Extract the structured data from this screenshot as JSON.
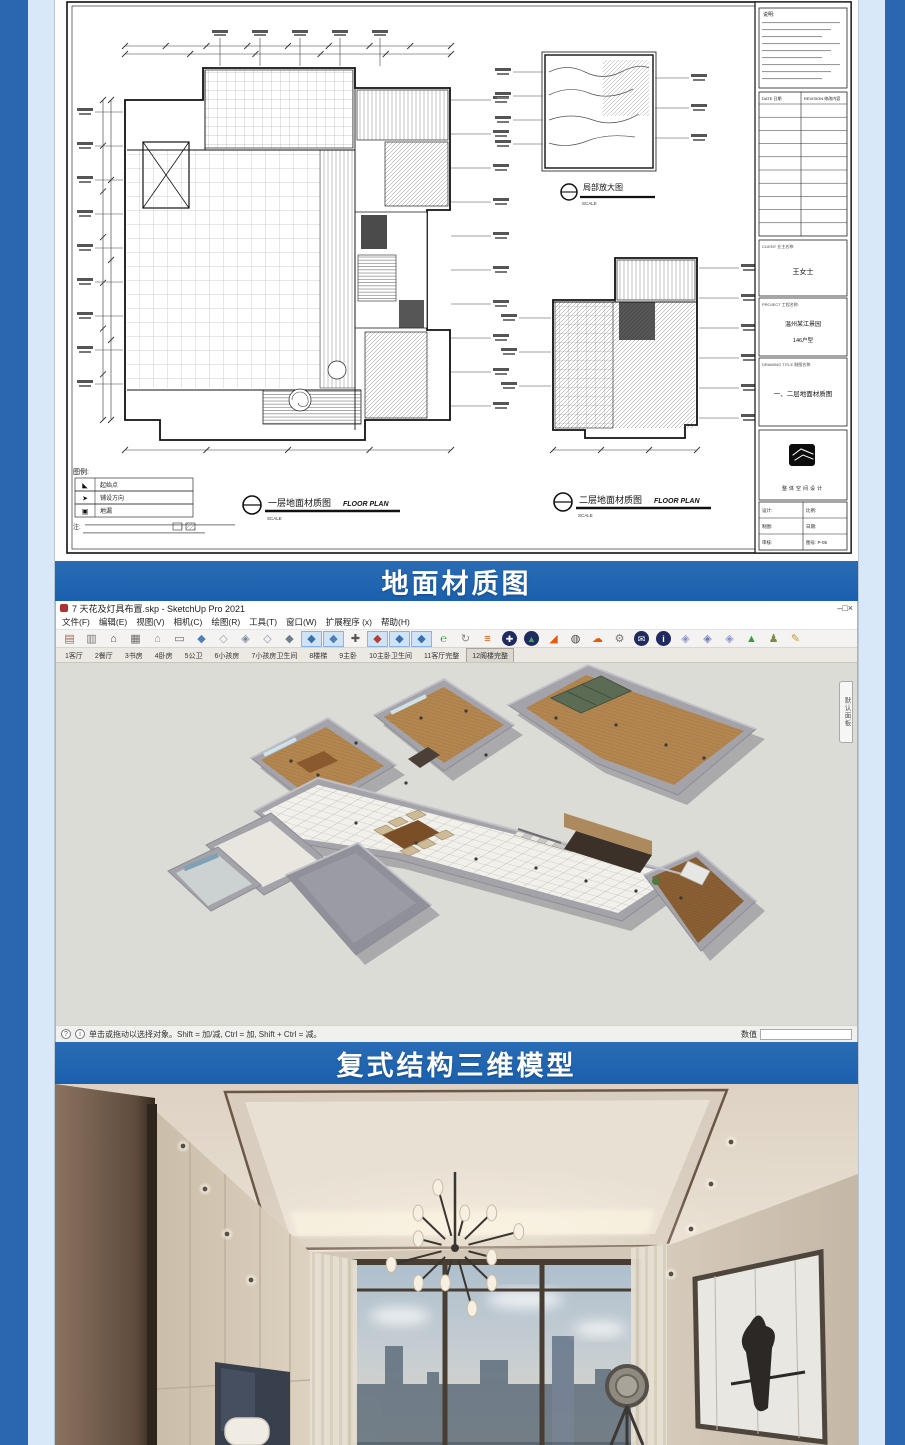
{
  "banners": {
    "floor_material": "地面材质图",
    "duplex_model": "复式结构三维模型"
  },
  "cad": {
    "captions": {
      "plan1": "一层地面材质图",
      "plan2": "二层地面材质图",
      "en": "FLOOR PLAN",
      "detail": "局部放大图",
      "scale": "SCALE"
    },
    "legend": {
      "title": "图例:",
      "rows": [
        {
          "icon": "start-point-icon",
          "glyph": "◣",
          "label": "起始点"
        },
        {
          "icon": "lay-direction-icon",
          "glyph": "➤",
          "label": "铺设方向"
        },
        {
          "icon": "floor-drain-icon",
          "glyph": "▣",
          "label": "地漏"
        }
      ],
      "note_label": "注:"
    },
    "titleblock": {
      "notes_title": "说明:",
      "rev_cols": [
        "DATE 日期",
        "REVISION 修改内容"
      ],
      "client_label": "CLIENT 业主名称:",
      "client_value": "王女士",
      "project_label": "PROJECT 工程名称:",
      "project_value": "温州某江景园",
      "project_unit": "146户型",
      "drawing_label": "DRAWING TITLE 制图名称:",
      "drawing_value": "一、二层地面材质图",
      "logo_text": "整体空间设计",
      "fields": [
        [
          "设计:",
          "比例:"
        ],
        [
          "制图:",
          "日期:"
        ],
        [
          "审核:",
          "图号: P-05"
        ]
      ]
    }
  },
  "sketchup": {
    "title": "7 天花及灯具布置.skp - SketchUp Pro 2021",
    "window_controls": [
      {
        "name": "minimize-button",
        "glyph": "–"
      },
      {
        "name": "maximize-button",
        "glyph": "□"
      },
      {
        "name": "close-button",
        "glyph": "×"
      }
    ],
    "menus": [
      "文件(F)",
      "编辑(E)",
      "视图(V)",
      "相机(C)",
      "绘图(R)",
      "工具(T)",
      "窗口(W)",
      "扩展程序 (x)",
      "帮助(H)"
    ],
    "toolbar_icons": [
      {
        "name": "model-cabinet",
        "glyph": "▤",
        "color": "#9a6a5a"
      },
      {
        "name": "component-box",
        "glyph": "▥",
        "color": "#7a7a7a"
      },
      {
        "name": "home",
        "glyph": "⌂",
        "color": "#4a4a4a"
      },
      {
        "name": "archive-box",
        "glyph": "▦",
        "color": "#6a6a6a"
      },
      {
        "name": "house-outline",
        "glyph": "⌂",
        "color": "#8a8a8a"
      },
      {
        "name": "tray-box",
        "glyph": "▭",
        "color": "#666666"
      },
      {
        "name": "cube-shaded",
        "glyph": "◆",
        "color": "#4f7fb5"
      },
      {
        "name": "cube-wire",
        "glyph": "◇",
        "color": "#9aa4ad"
      },
      {
        "name": "cube-xray",
        "glyph": "◈",
        "color": "#7d8b99"
      },
      {
        "name": "cube-hidden",
        "glyph": "◇",
        "color": "#8d9aa6"
      },
      {
        "name": "cube-mono",
        "glyph": "◆",
        "color": "#6f7e8c"
      },
      {
        "name": "cube-textured",
        "glyph": "◆",
        "color": "#3e6ea8",
        "hl": true
      },
      {
        "name": "cube-color",
        "glyph": "◆",
        "color": "#4f7fb5",
        "hl": true
      },
      {
        "name": "move-tool",
        "glyph": "✚",
        "color": "#555555"
      },
      {
        "name": "rotate-tool",
        "glyph": "◆",
        "color": "#b04038",
        "hl": true
      },
      {
        "name": "scale-tool",
        "glyph": "◆",
        "color": "#3a6fae",
        "hl": true
      },
      {
        "name": "offset-tool",
        "glyph": "◆",
        "color": "#3a6fae",
        "hl": true
      },
      {
        "name": "enscape-start",
        "glyph": "℮",
        "color": "#2f9e44"
      },
      {
        "name": "sync-view",
        "glyph": "↻",
        "color": "#888888"
      },
      {
        "name": "layers-orange",
        "glyph": "≡",
        "color": "#e8590c"
      },
      {
        "name": "add-object",
        "glyph": "✚",
        "color": "#ffffff",
        "bg": "#1e2a60"
      },
      {
        "name": "asset-tree",
        "glyph": "▲",
        "color": "#3fae4a",
        "bg": "#1e2a60"
      },
      {
        "name": "terrain-mountain",
        "glyph": "◢",
        "color": "#e8590c"
      },
      {
        "name": "material-sphere",
        "glyph": "◍",
        "color": "#444444"
      },
      {
        "name": "cloud-upload",
        "glyph": "☁",
        "color": "#e8590c"
      },
      {
        "name": "settings-gear",
        "glyph": "⚙",
        "color": "#777777"
      },
      {
        "name": "render-batch",
        "glyph": "✉",
        "color": "#ffffff",
        "bg": "#1e2a60"
      },
      {
        "name": "render-info",
        "glyph": "i",
        "color": "#ffffff",
        "bg": "#1e2a60"
      },
      {
        "name": "vray-asset",
        "glyph": "◈",
        "color": "#8a93c4"
      },
      {
        "name": "vray-render",
        "glyph": "◈",
        "color": "#6f79b5"
      },
      {
        "name": "vray-frame",
        "glyph": "◈",
        "color": "#8a93c4"
      },
      {
        "name": "analysis-mountain",
        "glyph": "▲",
        "color": "#2f9e44"
      },
      {
        "name": "people-scale",
        "glyph": "♟",
        "color": "#7a8a4a"
      },
      {
        "name": "sandbox-tools",
        "glyph": "✎",
        "color": "#c49a2a"
      }
    ],
    "scene_tabs": [
      "1客厅",
      "2餐厅",
      "3书房",
      "4卧房",
      "5公卫",
      "6小孩房",
      "7小孩房卫生间",
      "8楼梯",
      "9主卧",
      "10主卧卫生间",
      "11客厅完整",
      "12阁楼完整"
    ],
    "selected_tab_index": 11,
    "panel_tab": "默认面板",
    "status_icons": [
      "?",
      "i"
    ],
    "status_text": "单击或拖动以选择对象。Shift = 加/减, Ctrl = 加, Shift + Ctrl = 减。",
    "measure_label": "数值"
  },
  "colors": {
    "rail_blue": "#2a67b0",
    "panel_blue": "#d9e8f8",
    "banner_blue": "#1d63b0",
    "viewport_gray": "#dcdcd6",
    "wood_floor": "#b3854f",
    "tile_white": "#f2f0ea",
    "wall_gray": "#a3a3a9"
  }
}
